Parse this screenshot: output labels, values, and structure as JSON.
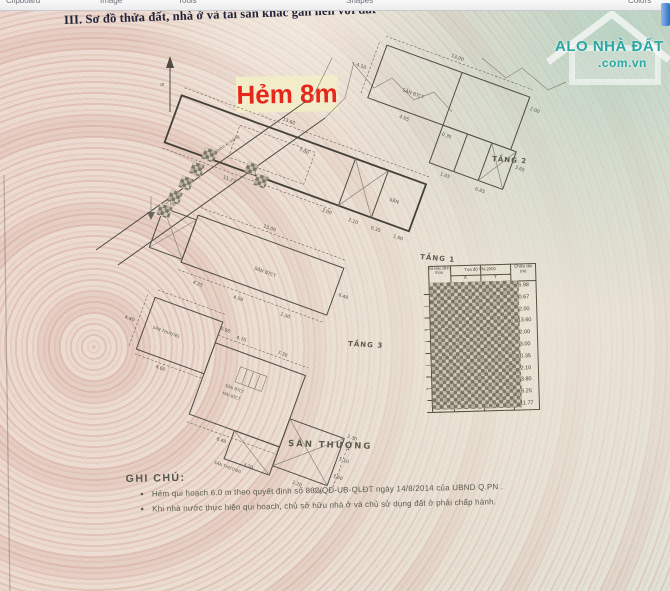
{
  "app": {
    "toolbar_tabs": [
      "Clipboard",
      "Image",
      "Tools",
      "Shapes",
      "Colors"
    ]
  },
  "scan": {
    "section_title": "III. Sơ đồ thửa đất, nhà ở và tài sản khác gắn liền với đất",
    "overlay_label": "Hẻm 8m",
    "watermark": {
      "brand": "ALO NHÀ ĐẤT",
      "domain": ".com.vn",
      "color": "#2aa7a2"
    },
    "compass": {
      "north": "B"
    },
    "alley_text": "hẻm xi măng",
    "floor_plans": {
      "tang1": {
        "label": "TẦNG 1",
        "room": "SÂN",
        "dims": [
          "13.60",
          "7.00",
          "3.00",
          "2.10",
          "0.35",
          "1.00",
          "11.77"
        ]
      },
      "tang2": {
        "label": "TẦNG 2",
        "room": "SÂN BTCT",
        "dims": [
          "13.00",
          "4.50",
          "2.00",
          "3.65",
          "1.05",
          "0.35",
          "4.05",
          "6.65"
        ]
      },
      "tang3": {
        "label": "TẦNG 3",
        "room": "SÂN BTCT",
        "dims": [
          "13.00",
          "4.25",
          "4.50",
          "6.40",
          "2.00",
          "2.30"
        ]
      },
      "san_thuong": {
        "label": "SÂN THƯỢNG",
        "rooms": [
          "SÂN THƯỢNG",
          "SÂN BTCT",
          "MÁI BTCT",
          "SÂN THƯỢNG"
        ],
        "dims": [
          "4.40",
          "4.70",
          "7.30",
          "2.30",
          "5.10",
          "3.60",
          "0.35",
          "2.20",
          "6.40",
          "3.20",
          "4.60",
          "0.90"
        ]
      }
    },
    "coordinate_table": {
      "col_point": "Số hiệu đỉnh thửa",
      "col_coords": "Tọa độ VN-2000",
      "col_x": "X",
      "col_y": "Y",
      "col_length_1": "Chiều dài",
      "col_length_2": "(m)",
      "lengths": [
        "6.98",
        "0.67",
        "2.00",
        "13.60",
        "2.00",
        "3.00",
        "0.35",
        "2.10",
        "3.80",
        "6.25",
        "11.77"
      ],
      "coordinates_censored": true
    },
    "notes": {
      "heading": "GHI CHÚ:",
      "bullet": "●",
      "items": [
        "Hẻm qui hoạch 6.0 m theo quyết định số 862/QĐ-UB-QLĐT ngày 14/8/2014 của UBND Q.PN .",
        "Khi nhà nước thực hiện qui hoạch, chủ sở hữu nhà ở và chủ sử dụng đất ở phải chấp hành."
      ]
    },
    "colors": {
      "overlay_red": "#e8271c",
      "overlay_bg": "#f2ecc9"
    }
  }
}
